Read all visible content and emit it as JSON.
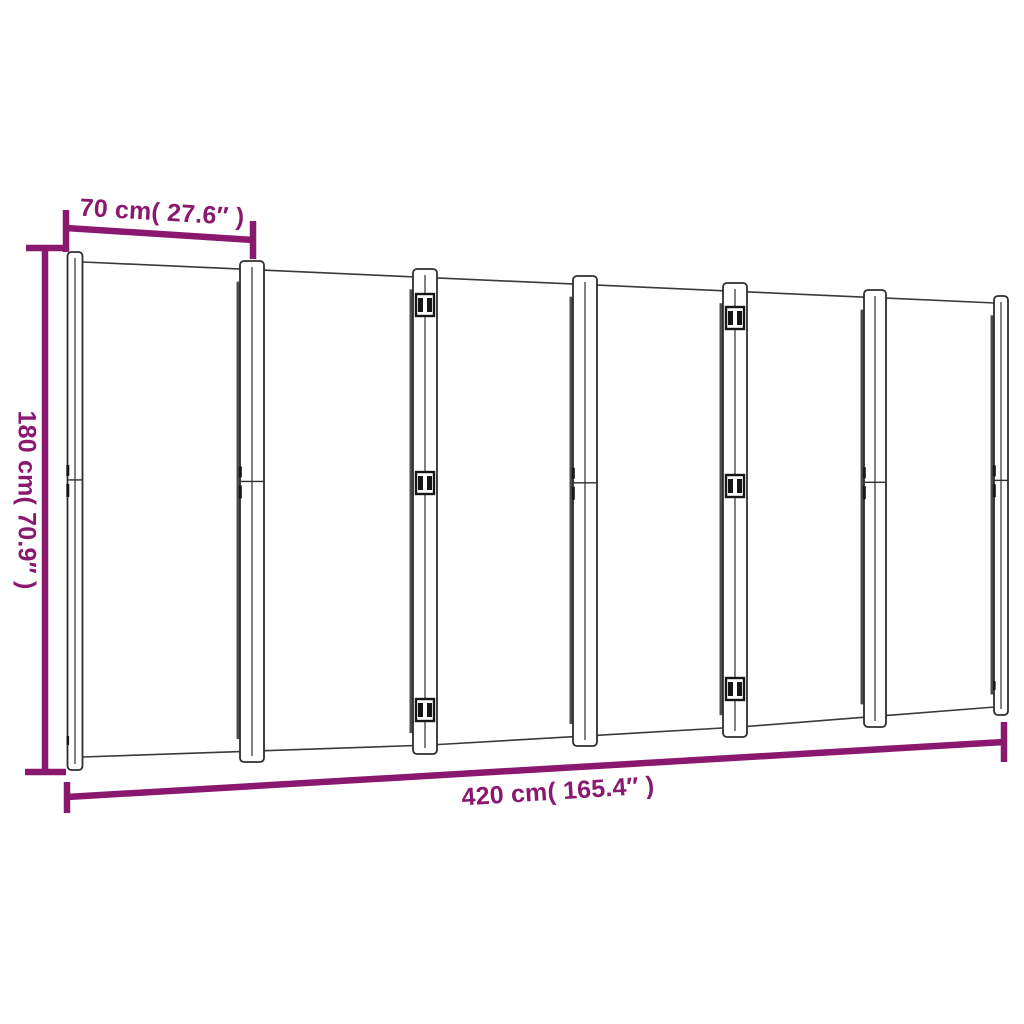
{
  "diagram": {
    "panels": 6,
    "labels": {
      "panel_width": "70 cm( 27.6″  )",
      "height": "180 cm( 70.9″  )",
      "total_width": "420 cm( 165.4″  )"
    },
    "colors": {
      "dimension_accent": "#8B186F",
      "outline": "#3A3A3A",
      "background": "#FFFFFF"
    }
  }
}
